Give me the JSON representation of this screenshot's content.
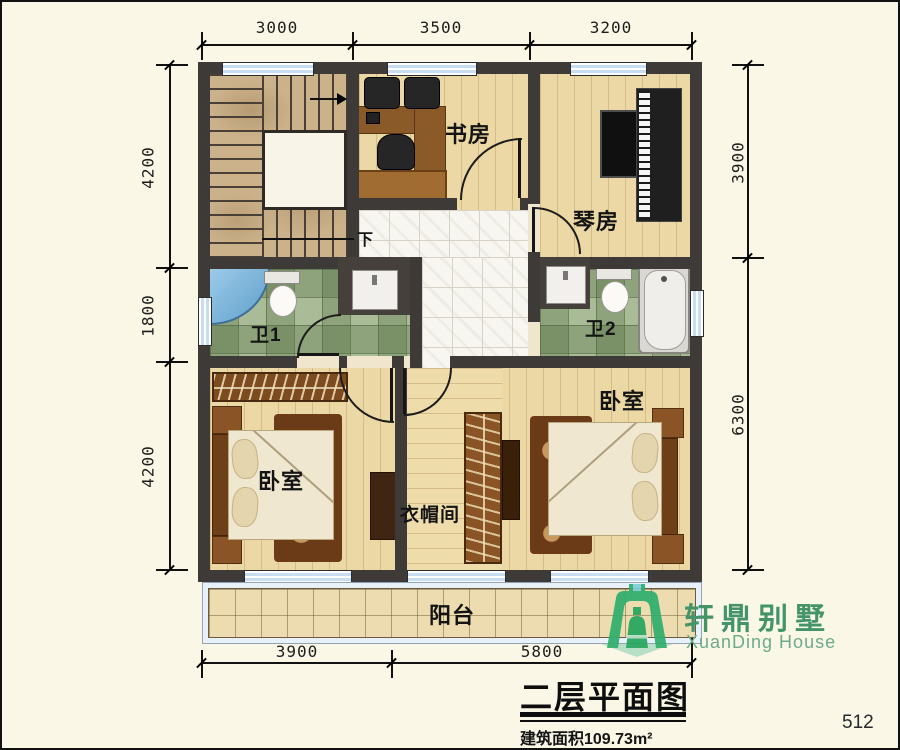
{
  "page": {
    "page_number": "512",
    "background": "#faf7e6"
  },
  "dimensions": {
    "top": [
      "3000",
      "3500",
      "3200"
    ],
    "left": [
      "4200",
      "1800",
      "4200"
    ],
    "right": [
      "3900",
      "6300"
    ],
    "bottom": [
      "3900",
      "5800"
    ]
  },
  "rooms": {
    "study": "书房",
    "piano_room": "琴房",
    "bathroom1": "卫1",
    "bathroom2": "卫2",
    "bedroom_left": "卧室",
    "bedroom_right": "卧室",
    "cloakroom": "衣帽间",
    "balcony": "阳台",
    "stairs_down_label": "下"
  },
  "branding": {
    "logo_cn": "轩鼎别墅",
    "logo_en": "XuanDing House",
    "logo_green": "#2fae6e"
  },
  "title_block": {
    "title": "二层平面图",
    "area_label": "建筑面积109.73m²"
  },
  "colors": {
    "wall": "#3e3a38",
    "window_glass": "#c8ddf1",
    "wood_floor": "#ecd8a5",
    "tile_green": "#aabc97",
    "hall_tile": "#f8f6f0",
    "balcony_floor": "#ecdcb0",
    "shower_blue": "#7fb2d8",
    "title_text": "#111111"
  }
}
